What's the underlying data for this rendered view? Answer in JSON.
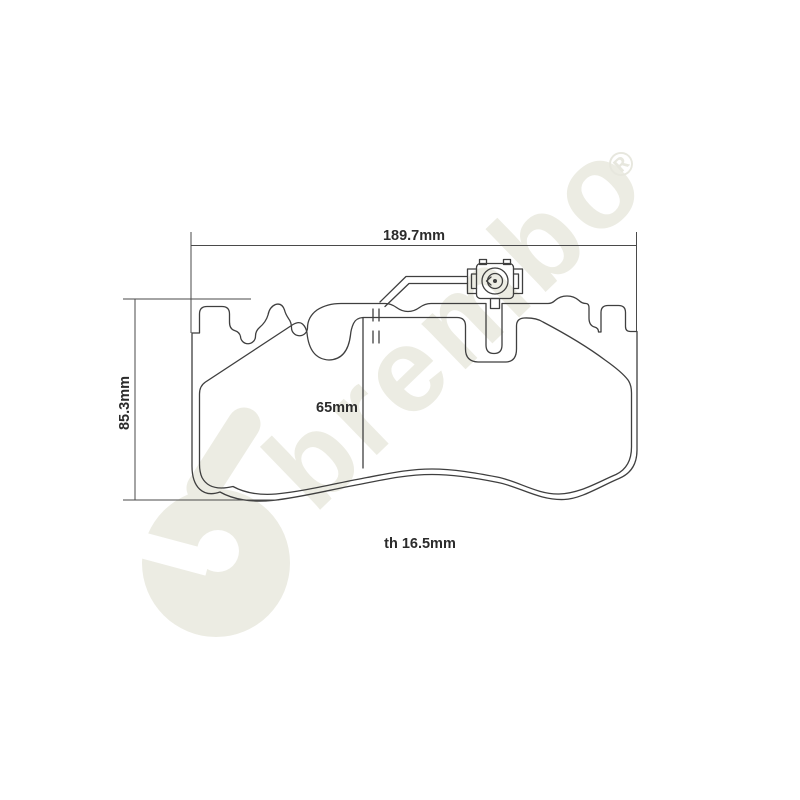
{
  "watermark": {
    "brand": "brembo",
    "registered_mark": "®",
    "color": "#ecece3",
    "angle_deg": -44
  },
  "drawing": {
    "type": "brake-pad technical drawing, front view",
    "line_color": "#3f3f3f",
    "text_color": "#2b2b2b",
    "background_color": "#ffffff",
    "labels": {
      "overall_width": "189.7mm",
      "overall_height": "85.3mm",
      "friction_height": "65mm",
      "thickness": "th 16.5mm"
    }
  }
}
